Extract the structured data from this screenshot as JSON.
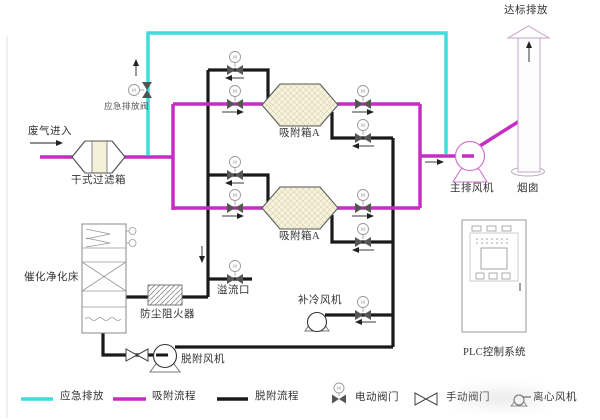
{
  "diagram": {
    "labels": {
      "waste_gas_in": "废气进入",
      "dry_filter_box": "干式过滤箱",
      "emergency_vent_valve": "应急排放阀",
      "adsorption_box_1": "吸附箱A",
      "adsorption_box_2": "吸附箱A",
      "main_exhaust_fan": "主排风机",
      "chimney": "烟囱",
      "compliant_discharge": "达标排放",
      "catalytic_bed": "催化净化床",
      "dust_flame_arrester": "防尘阻火器",
      "overflow_port": "溢流口",
      "makeup_cooling_fan": "补冷风机",
      "desorption_fan": "脱附风机",
      "plc_system": "PLC控制系统"
    },
    "symbols": {
      "motor_letter": "M"
    },
    "colors": {
      "emergency": "#3fdcdc",
      "adsorption": "#c32ec3",
      "desorption": "#1a1a1a",
      "box_fill": "#f7f3dd",
      "chimney_outline": "#c9a2c9",
      "fan_outline": "#cf74cf"
    },
    "legend": {
      "line_items": [
        {
          "label": "应急排放",
          "color": "#3fdcdc"
        },
        {
          "label": "吸附流程",
          "color": "#c32ec3"
        },
        {
          "label": "脱附流程",
          "color": "#1a1a1a"
        }
      ],
      "symbol_items": [
        {
          "label": "电动阀门",
          "symbol": "motor-valve"
        },
        {
          "label": "手动阀门",
          "symbol": "manual-valve"
        },
        {
          "label": "离心风机",
          "symbol": "centrifugal-fan"
        }
      ]
    }
  }
}
